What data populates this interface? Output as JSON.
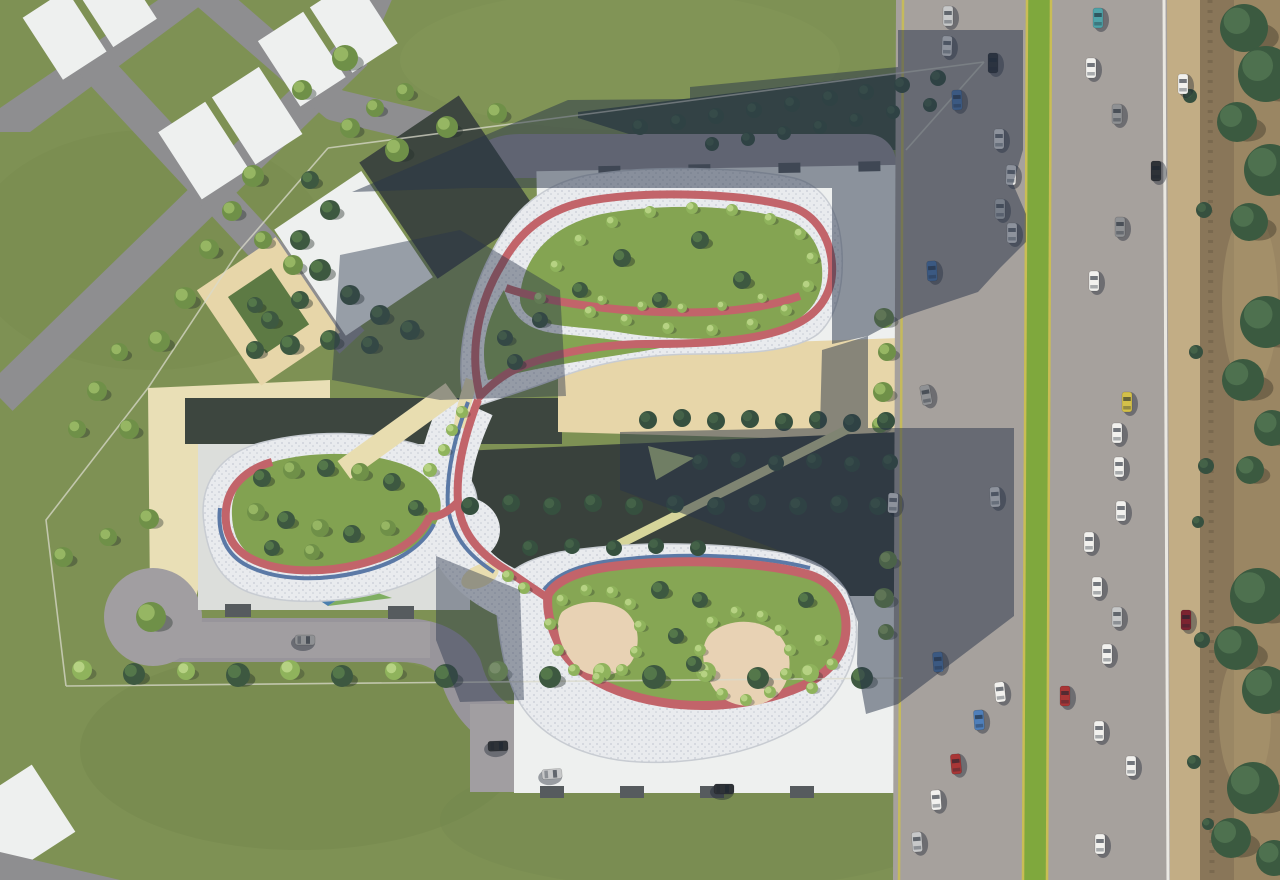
{
  "scene": {
    "kind": "aerial-architectural-site-plan-render",
    "canvas": {
      "w": 1280,
      "h": 880
    },
    "regions": {
      "left": "neighboring-parcels-grass-and-roads",
      "center": "residential-complex-with-figure8-roof-park",
      "right": "multilane-highway-with-median-and-roadside-scrub"
    }
  },
  "palette": {
    "grass": "#7e9154",
    "grassDark": "#70834b",
    "grassLight": "#8a9e5e",
    "roadNeighbor": "#8e8e90",
    "roadSite": "#98959b",
    "roadSiteLit": "#a19ea1",
    "highway": "#a6a19d",
    "median": "#7fa83d",
    "laneYellow": "#c9bd55",
    "lineWhite": "#eae8e2",
    "shoulder": "#c2ad85",
    "scrubBase": "#9a8663",
    "scrubBand": "#897659",
    "dirtLight": "#ab9770",
    "guardPost": "#77664c",
    "fence": "#d9dacb",
    "mosaicBase": "#e9ebee",
    "mosaicDot1": "#cfd3da",
    "mosaicDot2": "#c6cbd4",
    "mosaicEdge": "#c8ccd2",
    "track": "#c2646a",
    "trackBlue": "#5b79a6",
    "beigePath": "#e8ddb0",
    "lawnTop": "#84a452",
    "lawnWest": "#82a251",
    "lawnBottom": "#86a654",
    "sand": "#e8d2b4",
    "plaza": "#e9dfb6",
    "beigeCourt": "#e7d6a9",
    "courtGreen": "#5d7a44",
    "roofWhite": "#eef0ef",
    "roofGray": "#dcdedb",
    "roofNotch": "#565b5e",
    "slabDark": "#3d463f",
    "slabDark2": "#39413c",
    "shrubTriangle": "#3f5140",
    "yellowPath": "#d6d59a",
    "yellowTri": "#b8c87e",
    "glassBlue": "#4a7fae",
    "glassGreen": "#7fae62",
    "shadow": "rgba(40,52,74,0.50)",
    "shadowSoft": "rgba(40,52,74,0.44)"
  },
  "cars": {
    "colors": {
      "wh": "#f2f1ee",
      "sv": "#c7c8c9",
      "gy": "#8f9194",
      "bk": "#2e3237",
      "bl": "#4f7fba",
      "te": "#4fa3a8",
      "ye": "#d3c04a",
      "rd": "#a93636",
      "dr": "#7c2430"
    },
    "shadow": "rgba(25,32,48,0.4)",
    "items": [
      [
        948,
        16,
        0,
        "sv"
      ],
      [
        947,
        46,
        2,
        "wh"
      ],
      [
        993,
        63,
        0,
        "bk"
      ],
      [
        957,
        100,
        -2,
        "bl"
      ],
      [
        999,
        139,
        0,
        "wh"
      ],
      [
        1011,
        175,
        2,
        "wh"
      ],
      [
        1000,
        209,
        0,
        "sv"
      ],
      [
        1012,
        233,
        0,
        "wh"
      ],
      [
        932,
        271,
        -3,
        "bl"
      ],
      [
        926,
        395,
        -10,
        "gy"
      ],
      [
        995,
        497,
        -3,
        "wh"
      ],
      [
        938,
        662,
        -4,
        "bl"
      ],
      [
        1000,
        692,
        -6,
        "wh"
      ],
      [
        979,
        720,
        -4,
        "bl"
      ],
      [
        956,
        764,
        -5,
        "rd"
      ],
      [
        936,
        800,
        -4,
        "wh"
      ],
      [
        917,
        842,
        -4,
        "sv"
      ],
      [
        1098,
        18,
        0,
        "te"
      ],
      [
        1091,
        68,
        0,
        "wh"
      ],
      [
        1117,
        114,
        0,
        "gy"
      ],
      [
        1156,
        171,
        0,
        "bk"
      ],
      [
        1120,
        227,
        0,
        "gy"
      ],
      [
        1094,
        281,
        0,
        "wh"
      ],
      [
        1127,
        402,
        0,
        "ye"
      ],
      [
        1117,
        433,
        0,
        "wh"
      ],
      [
        1119,
        467,
        0,
        "wh"
      ],
      [
        1121,
        511,
        0,
        "wh"
      ],
      [
        1089,
        542,
        0,
        "wh"
      ],
      [
        1097,
        587,
        0,
        "wh"
      ],
      [
        1117,
        617,
        0,
        "sv"
      ],
      [
        1107,
        654,
        0,
        "wh"
      ],
      [
        1065,
        696,
        0,
        "rd"
      ],
      [
        1099,
        731,
        0,
        "wh"
      ],
      [
        1131,
        766,
        0,
        "wh"
      ],
      [
        1100,
        844,
        0,
        "wh"
      ],
      [
        1183,
        84,
        0,
        "wh"
      ],
      [
        1186,
        620,
        0,
        "dr"
      ],
      [
        305,
        640,
        90,
        "gy"
      ],
      [
        498,
        746,
        88,
        "bk"
      ],
      [
        552,
        774,
        86,
        "sv"
      ],
      [
        724,
        789,
        90,
        "bk"
      ],
      [
        893,
        503,
        2,
        "wh"
      ]
    ]
  },
  "vegetation": {
    "types": {
      "p": {
        "base": "#6f9048",
        "hi": "#9dbd68",
        "sh": "rgba(35,45,40,0.38)"
      },
      "b": {
        "base": "#8fb35c",
        "hi": "#bdd789",
        "sh": "rgba(35,45,40,0.30)"
      },
      "d": {
        "base": "#3d5840",
        "hi": "#587c4c",
        "sh": "rgba(30,40,36,0.40)"
      },
      "n": {
        "base": "#36503f",
        "hi": "#47654a",
        "sh": null
      },
      "s": {
        "base": "#3b5a40",
        "hi": "#527552",
        "sh": "rgba(40,36,28,0.35)"
      }
    },
    "items": [
      [
        345,
        58,
        13,
        "p"
      ],
      [
        302,
        90,
        10,
        "p"
      ],
      [
        397,
        150,
        12,
        "p"
      ],
      [
        447,
        127,
        11,
        "p"
      ],
      [
        497,
        113,
        10,
        "p"
      ],
      [
        253,
        176,
        11,
        "p"
      ],
      [
        232,
        211,
        10,
        "p"
      ],
      [
        209,
        249,
        10,
        "p"
      ],
      [
        263,
        240,
        9,
        "p"
      ],
      [
        293,
        265,
        10,
        "p"
      ],
      [
        185,
        298,
        11,
        "p"
      ],
      [
        159,
        341,
        11,
        "p"
      ],
      [
        119,
        352,
        9,
        "p"
      ],
      [
        97,
        391,
        10,
        "p"
      ],
      [
        77,
        429,
        9,
        "p"
      ],
      [
        129,
        429,
        10,
        "p"
      ],
      [
        149,
        519,
        10,
        "p"
      ],
      [
        108,
        537,
        9,
        "p"
      ],
      [
        63,
        557,
        10,
        "p"
      ],
      [
        350,
        128,
        10,
        "p"
      ],
      [
        375,
        108,
        9,
        "p"
      ],
      [
        405,
        92,
        9,
        "p"
      ],
      [
        310,
        180,
        9,
        "d"
      ],
      [
        330,
        210,
        10,
        "d"
      ],
      [
        300,
        240,
        10,
        "d"
      ],
      [
        320,
        270,
        11,
        "d"
      ],
      [
        350,
        295,
        10,
        "d"
      ],
      [
        380,
        315,
        10,
        "d"
      ],
      [
        300,
        300,
        9,
        "d"
      ],
      [
        270,
        320,
        9,
        "d"
      ],
      [
        255,
        350,
        9,
        "d"
      ],
      [
        290,
        345,
        10,
        "d"
      ],
      [
        330,
        340,
        10,
        "d"
      ],
      [
        370,
        345,
        9,
        "d"
      ],
      [
        410,
        330,
        10,
        "d"
      ],
      [
        255,
        305,
        8,
        "d"
      ],
      [
        640,
        127,
        8,
        "n"
      ],
      [
        678,
        122,
        8,
        "n"
      ],
      [
        716,
        116,
        8,
        "n"
      ],
      [
        754,
        110,
        8,
        "n"
      ],
      [
        792,
        104,
        8,
        "n"
      ],
      [
        830,
        98,
        8,
        "n"
      ],
      [
        866,
        92,
        8,
        "n"
      ],
      [
        902,
        85,
        8,
        "n"
      ],
      [
        938,
        78,
        8,
        "n"
      ],
      [
        930,
        105,
        7,
        "n"
      ],
      [
        893,
        112,
        7,
        "n"
      ],
      [
        856,
        120,
        7,
        "n"
      ],
      [
        820,
        127,
        7,
        "n"
      ],
      [
        784,
        133,
        7,
        "n"
      ],
      [
        748,
        139,
        7,
        "n"
      ],
      [
        712,
        144,
        7,
        "n"
      ],
      [
        151,
        617,
        15,
        "p"
      ],
      [
        82,
        670,
        10,
        "b"
      ],
      [
        134,
        674,
        11,
        "d"
      ],
      [
        186,
        671,
        9,
        "b"
      ],
      [
        238,
        675,
        12,
        "d"
      ],
      [
        290,
        670,
        10,
        "b"
      ],
      [
        342,
        676,
        11,
        "d"
      ],
      [
        394,
        671,
        9,
        "b"
      ],
      [
        446,
        676,
        12,
        "d"
      ],
      [
        498,
        671,
        10,
        "b"
      ],
      [
        550,
        677,
        11,
        "d"
      ],
      [
        602,
        672,
        9,
        "b"
      ],
      [
        654,
        677,
        12,
        "d"
      ],
      [
        706,
        672,
        10,
        "b"
      ],
      [
        758,
        678,
        11,
        "d"
      ],
      [
        810,
        673,
        9,
        "b"
      ],
      [
        862,
        678,
        11,
        "d"
      ],
      [
        884,
        318,
        10,
        "p"
      ],
      [
        887,
        352,
        9,
        "p"
      ],
      [
        883,
        392,
        10,
        "p"
      ],
      [
        880,
        425,
        8,
        "p"
      ],
      [
        888,
        560,
        9,
        "p"
      ],
      [
        884,
        598,
        10,
        "p"
      ],
      [
        886,
        632,
        8,
        "p"
      ],
      [
        622,
        258,
        9,
        "d"
      ],
      [
        700,
        240,
        9,
        "d"
      ],
      [
        742,
        280,
        9,
        "d"
      ],
      [
        580,
        290,
        8,
        "d"
      ],
      [
        660,
        300,
        8,
        "d"
      ],
      [
        540,
        320,
        8,
        "d"
      ],
      [
        505,
        338,
        8,
        "d"
      ],
      [
        515,
        362,
        8,
        "d"
      ],
      [
        540,
        298,
        6,
        "b"
      ],
      [
        556,
        266,
        6,
        "b"
      ],
      [
        580,
        240,
        6,
        "b"
      ],
      [
        612,
        222,
        6,
        "b"
      ],
      [
        650,
        212,
        6,
        "b"
      ],
      [
        692,
        208,
        6,
        "b"
      ],
      [
        732,
        210,
        6,
        "b"
      ],
      [
        770,
        219,
        6,
        "b"
      ],
      [
        800,
        234,
        6,
        "b"
      ],
      [
        812,
        258,
        6,
        "b"
      ],
      [
        808,
        286,
        6,
        "b"
      ],
      [
        786,
        310,
        6,
        "b"
      ],
      [
        752,
        324,
        6,
        "b"
      ],
      [
        712,
        330,
        6,
        "b"
      ],
      [
        668,
        328,
        6,
        "b"
      ],
      [
        626,
        320,
        6,
        "b"
      ],
      [
        590,
        312,
        6,
        "b"
      ],
      [
        602,
        300,
        5,
        "b"
      ],
      [
        642,
        306,
        5,
        "b"
      ],
      [
        682,
        308,
        5,
        "b"
      ],
      [
        722,
        306,
        5,
        "b"
      ],
      [
        762,
        298,
        5,
        "b"
      ],
      [
        262,
        478,
        9,
        "d"
      ],
      [
        292,
        470,
        9,
        "p"
      ],
      [
        326,
        468,
        9,
        "d"
      ],
      [
        360,
        472,
        9,
        "p"
      ],
      [
        392,
        482,
        9,
        "d"
      ],
      [
        256,
        512,
        9,
        "p"
      ],
      [
        286,
        520,
        9,
        "d"
      ],
      [
        320,
        528,
        9,
        "p"
      ],
      [
        352,
        534,
        9,
        "d"
      ],
      [
        388,
        528,
        8,
        "p"
      ],
      [
        416,
        508,
        8,
        "d"
      ],
      [
        272,
        548,
        8,
        "d"
      ],
      [
        312,
        552,
        8,
        "p"
      ],
      [
        430,
        470,
        7,
        "b"
      ],
      [
        444,
        450,
        6,
        "b"
      ],
      [
        452,
        430,
        6,
        "b"
      ],
      [
        462,
        412,
        6,
        "b"
      ],
      [
        508,
        576,
        6,
        "b"
      ],
      [
        524,
        588,
        6,
        "b"
      ],
      [
        562,
        600,
        6,
        "b"
      ],
      [
        586,
        590,
        6,
        "b"
      ],
      [
        612,
        592,
        6,
        "b"
      ],
      [
        630,
        604,
        6,
        "b"
      ],
      [
        640,
        626,
        6,
        "b"
      ],
      [
        636,
        652,
        6,
        "b"
      ],
      [
        622,
        670,
        6,
        "b"
      ],
      [
        598,
        678,
        6,
        "b"
      ],
      [
        574,
        670,
        6,
        "b"
      ],
      [
        558,
        650,
        6,
        "b"
      ],
      [
        550,
        624,
        6,
        "b"
      ],
      [
        712,
        622,
        6,
        "b"
      ],
      [
        736,
        612,
        6,
        "b"
      ],
      [
        762,
        616,
        6,
        "b"
      ],
      [
        780,
        630,
        6,
        "b"
      ],
      [
        790,
        650,
        6,
        "b"
      ],
      [
        786,
        674,
        6,
        "b"
      ],
      [
        770,
        692,
        6,
        "b"
      ],
      [
        746,
        700,
        6,
        "b"
      ],
      [
        722,
        694,
        6,
        "b"
      ],
      [
        706,
        676,
        6,
        "b"
      ],
      [
        700,
        650,
        6,
        "b"
      ],
      [
        660,
        590,
        9,
        "d"
      ],
      [
        700,
        600,
        8,
        "d"
      ],
      [
        806,
        600,
        8,
        "d"
      ],
      [
        676,
        636,
        8,
        "d"
      ],
      [
        694,
        664,
        8,
        "d"
      ],
      [
        820,
        640,
        6,
        "b"
      ],
      [
        832,
        664,
        6,
        "b"
      ],
      [
        812,
        688,
        6,
        "b"
      ],
      [
        648,
        420,
        9,
        "n"
      ],
      [
        682,
        418,
        9,
        "n"
      ],
      [
        716,
        421,
        9,
        "n"
      ],
      [
        750,
        419,
        9,
        "n"
      ],
      [
        784,
        422,
        9,
        "n"
      ],
      [
        818,
        420,
        9,
        "n"
      ],
      [
        852,
        423,
        9,
        "n"
      ],
      [
        886,
        421,
        9,
        "n"
      ],
      [
        700,
        462,
        8,
        "n"
      ],
      [
        738,
        460,
        8,
        "n"
      ],
      [
        776,
        463,
        8,
        "n"
      ],
      [
        814,
        461,
        8,
        "n"
      ],
      [
        852,
        464,
        8,
        "n"
      ],
      [
        890,
        462,
        8,
        "n"
      ],
      [
        470,
        506,
        9,
        "n"
      ],
      [
        511,
        503,
        9,
        "n"
      ],
      [
        552,
        506,
        9,
        "n"
      ],
      [
        593,
        503,
        9,
        "n"
      ],
      [
        634,
        506,
        9,
        "n"
      ],
      [
        675,
        504,
        9,
        "n"
      ],
      [
        716,
        506,
        9,
        "n"
      ],
      [
        757,
        503,
        9,
        "n"
      ],
      [
        798,
        506,
        9,
        "n"
      ],
      [
        839,
        504,
        9,
        "n"
      ],
      [
        878,
        506,
        9,
        "n"
      ],
      [
        530,
        548,
        8,
        "n"
      ],
      [
        572,
        546,
        8,
        "n"
      ],
      [
        614,
        548,
        8,
        "n"
      ],
      [
        656,
        546,
        8,
        "n"
      ],
      [
        698,
        548,
        8,
        "n"
      ],
      [
        1244,
        28,
        24,
        "s"
      ],
      [
        1266,
        74,
        28,
        "s"
      ],
      [
        1237,
        122,
        20,
        "s"
      ],
      [
        1270,
        170,
        26,
        "s"
      ],
      [
        1249,
        222,
        19,
        "s"
      ],
      [
        1266,
        322,
        26,
        "s"
      ],
      [
        1243,
        380,
        21,
        "s"
      ],
      [
        1272,
        428,
        18,
        "s"
      ],
      [
        1258,
        596,
        28,
        "s"
      ],
      [
        1236,
        648,
        22,
        "s"
      ],
      [
        1266,
        690,
        24,
        "s"
      ],
      [
        1253,
        788,
        26,
        "s"
      ],
      [
        1231,
        838,
        20,
        "s"
      ],
      [
        1274,
        858,
        18,
        "s"
      ],
      [
        1250,
        470,
        14,
        "s"
      ],
      [
        1190,
        96,
        7,
        "n"
      ],
      [
        1204,
        210,
        8,
        "n"
      ],
      [
        1196,
        352,
        7,
        "n"
      ],
      [
        1206,
        466,
        8,
        "n"
      ],
      [
        1198,
        522,
        6,
        "n"
      ],
      [
        1202,
        640,
        8,
        "n"
      ],
      [
        1194,
        762,
        7,
        "n"
      ],
      [
        1208,
        824,
        6,
        "n"
      ]
    ]
  }
}
